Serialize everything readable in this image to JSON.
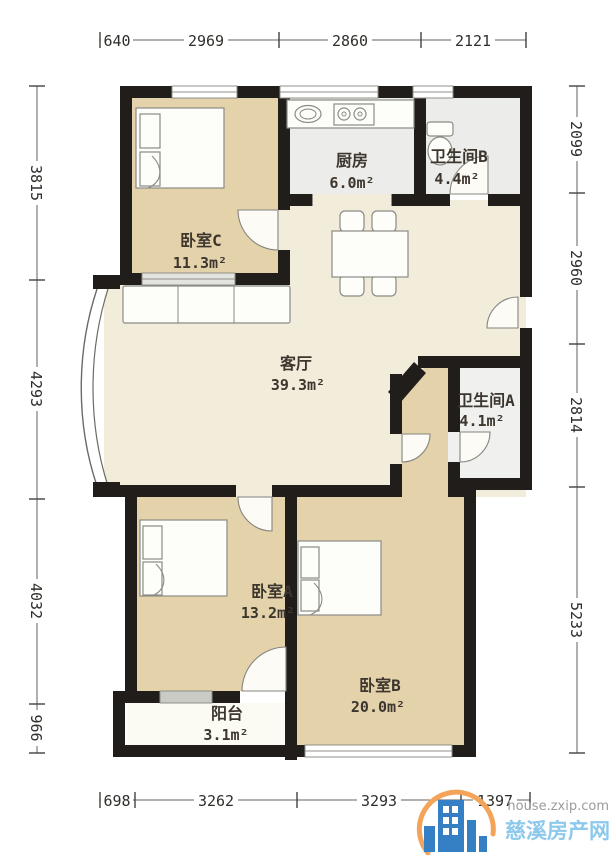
{
  "title": "apartment-floorplan",
  "rooms": [
    {
      "id": "bedroom-c",
      "name": "卧室C",
      "area": "11.3m²"
    },
    {
      "id": "kitchen",
      "name": "厨房",
      "area": "6.0m²"
    },
    {
      "id": "bathroom-b",
      "name": "卫生间B",
      "area": "4.4m²"
    },
    {
      "id": "living",
      "name": "客厅",
      "area": "39.3m²"
    },
    {
      "id": "bathroom-a",
      "name": "卫生间A",
      "area": "4.1m²"
    },
    {
      "id": "bedroom-a",
      "name": "卧室A",
      "area": "13.2m²"
    },
    {
      "id": "bedroom-b",
      "name": "卧室B",
      "area": "20.0m²"
    },
    {
      "id": "balcony",
      "name": "阳台",
      "area": "3.1m²"
    }
  ],
  "dimensions": {
    "top": [
      "640",
      "2969",
      "2860",
      "2121"
    ],
    "bottom": [
      "698",
      "3262",
      "3293",
      "1397"
    ],
    "left": [
      "3815",
      "4293",
      "4032",
      "966"
    ],
    "right": [
      "2099",
      "2960",
      "2814",
      "5233"
    ]
  },
  "watermark": {
    "domain": "house.zxip.com",
    "site_name": "慈溪房产网"
  },
  "colors": {
    "wall": "#201d1b",
    "bedroom_fill": "#e4d2ab",
    "living_fill": "#f2ecdb",
    "wet_room_fill": "#ececea",
    "balcony_fill": "#fbfaf3",
    "watermark_blue": "#8dc9ec",
    "logo_blue": "#3580c4",
    "logo_orange": "#f3a459"
  }
}
